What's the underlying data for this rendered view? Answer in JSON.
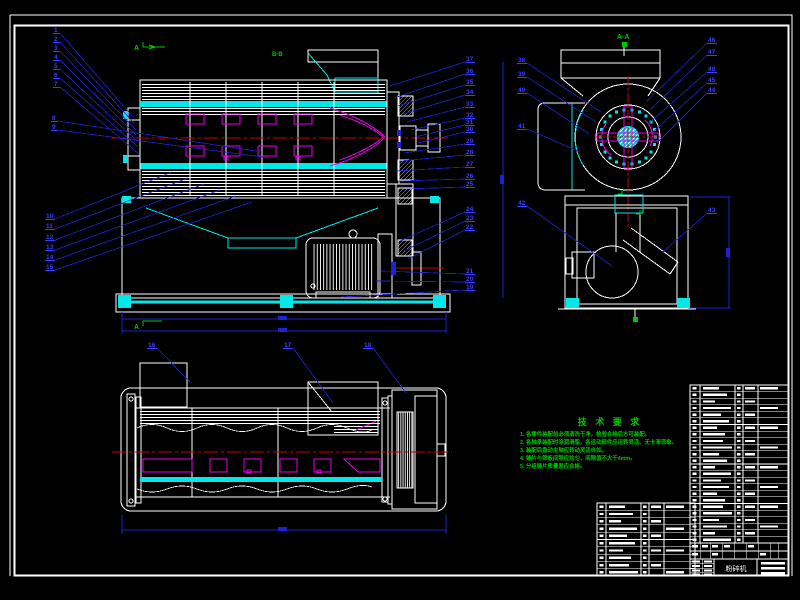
{
  "drawing": {
    "type": "engineering-assembly-drawing",
    "subject": "hammer-mill-crusher",
    "colors": {
      "background": "#000000",
      "line": "#ffffff",
      "cyan": "#00e8e8",
      "blue_leader": "#2121d4",
      "blue_text": "#3c3cff",
      "red_centerline": "#c80000",
      "magenta": "#e800e8",
      "green": "#00c800"
    },
    "section_labels": {
      "top_left_arrow": "A",
      "bottom_left_arrow": "A",
      "mid_label": "B-B",
      "end_view_label": "A-A"
    },
    "tech_requirements": {
      "title": "技 术 要 求",
      "lines": [
        "1. 各零件装配前必须清洗干净，检验合格后方可装配。",
        "2. 各轴承装配时涂润滑脂，各运动部件应运转灵活、无卡滞现象。",
        "3. 装配后盘动主轴应转动灵活自如。",
        "4. 锤片与筛板间隙应均匀，间隙值不大于4mm。",
        "5. 分组锤片质量差应合格。"
      ]
    },
    "callouts": {
      "main_left_stack": [
        "1",
        "2",
        "3",
        "4",
        "5",
        "6",
        "7"
      ],
      "main_left_mid": [
        "8",
        "9"
      ],
      "main_left_lower": [
        "10",
        "11",
        "12",
        "13",
        "14",
        "15"
      ],
      "bottom_view": [
        "16",
        "17",
        "18"
      ],
      "main_right": [
        "37",
        "36",
        "35",
        "34",
        "33",
        "32",
        "31",
        "30",
        "29",
        "28",
        "27",
        "26",
        "25",
        "24",
        "23",
        "22",
        "21",
        "20",
        "19"
      ],
      "end_left": [
        "38",
        "39",
        "40",
        "41",
        "42"
      ],
      "end_right": [
        "46",
        "47",
        "48",
        "45",
        "44",
        "43"
      ]
    },
    "title_block": {
      "name": "粉碎机"
    }
  }
}
